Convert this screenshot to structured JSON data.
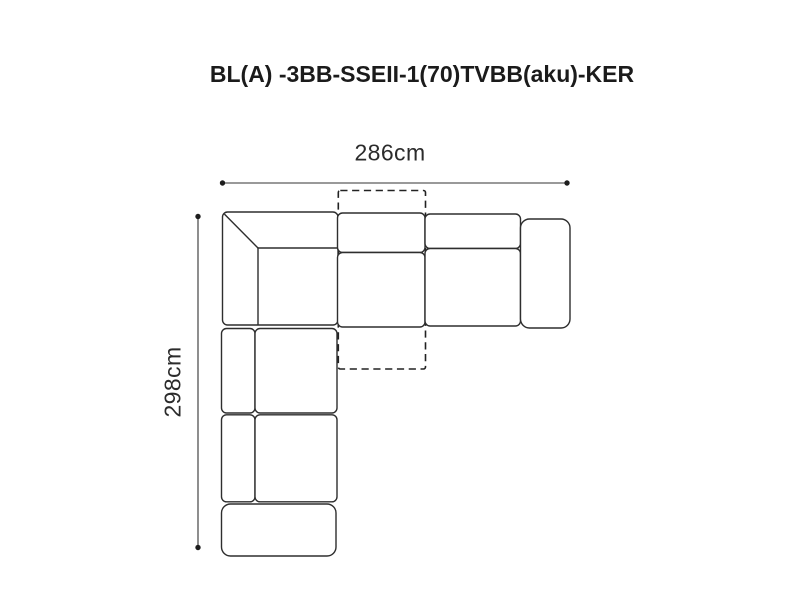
{
  "page": {
    "background": "#ffffff"
  },
  "title": {
    "text": "BL(A) -3BB-SSEII-1(70)TVBB(aku)-KER",
    "color": "#1b1b1b"
  },
  "dimensions": {
    "width": {
      "label": "286cm"
    },
    "height": {
      "label": "298cm"
    }
  },
  "diagram": {
    "kind": "corner-sofa-top-view-plan",
    "line_color": "#2e2e2e",
    "dimension_color": "#333333",
    "modules": [
      {
        "name": "corner-module"
      },
      {
        "name": "middle-seat-module"
      },
      {
        "name": "right-seat-module"
      },
      {
        "name": "right-armrest"
      },
      {
        "name": "left-seat-module-1"
      },
      {
        "name": "left-seat-module-2"
      },
      {
        "name": "bottom-armrest"
      },
      {
        "name": "tv-function-dashed-outline"
      }
    ]
  }
}
